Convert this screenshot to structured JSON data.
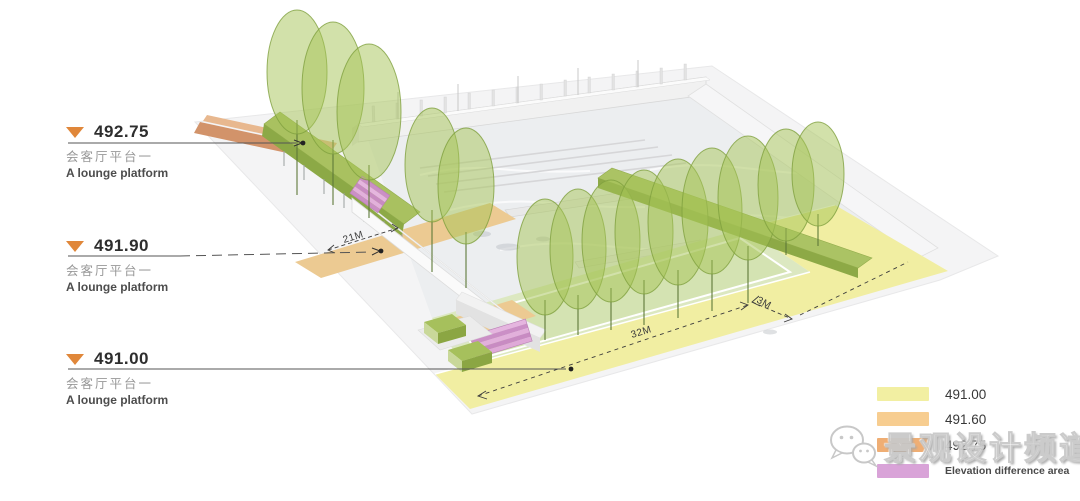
{
  "drawing": {
    "elevation_labels": [
      {
        "value": "492.75",
        "zh": "会客厅平台一",
        "en": "A lounge platform"
      },
      {
        "value": "491.90",
        "zh": "会客厅平台一",
        "en": "A lounge platform"
      },
      {
        "value": "491.00",
        "zh": "会客厅平台一",
        "en": "A lounge platform"
      }
    ],
    "dimensions": {
      "path_width": "21M",
      "lawn_length": "32M",
      "band_width": "3M"
    }
  },
  "legend": {
    "items": [
      {
        "label": "491.00",
        "color": "#f2efa2"
      },
      {
        "label": "491.60",
        "color": "#f7cd90"
      },
      {
        "label": "492.75",
        "color": "#efae74"
      },
      {
        "label": "Elevation difference area",
        "color": "#d9a3d8"
      }
    ]
  },
  "watermark": {
    "text": "景观设计频道"
  },
  "colors": {
    "marker_orange": "#e0873a",
    "tree_green": "#a5c356",
    "hedge_green": "#a9c160",
    "lawn_green": "#dce8c1",
    "path_tan": "#ecca92",
    "ramp_terracotta": "#d2936a",
    "steps_pink": "#cb8fc6",
    "band_yellow": "#f1eea2"
  }
}
